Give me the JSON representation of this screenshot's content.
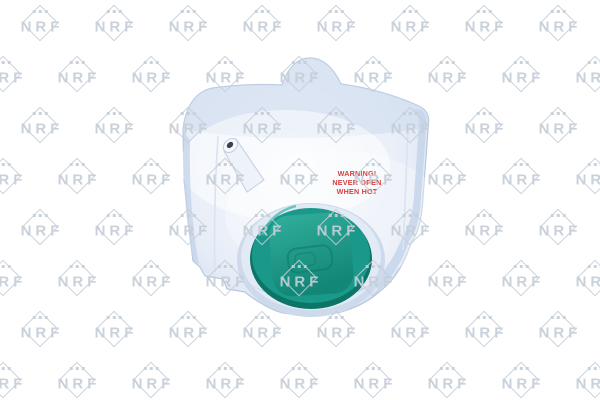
{
  "watermark": {
    "brand": "NRF",
    "color": "#c5ced8"
  },
  "product": {
    "name": "coolant-expansion-tank",
    "tank": {
      "highlight_color": "#f8fafd",
      "base_color": "#e7edf7",
      "edge_color": "#c6d5ea",
      "lid_color": "#cfdcee",
      "outline_color": "#b6c7dd"
    },
    "nozzle": {
      "body_color": "#eef3fa",
      "opening_color": "#3c4148"
    },
    "cap": {
      "base_color": "#0c7568",
      "ring_color": "#1a998a",
      "face_light_color": "#31ae9c",
      "face_dark_color": "#128677",
      "emboss_color": "#0d7c6e"
    },
    "warning": {
      "color": "#d6403f",
      "lines": [
        "WARNING!",
        "NEVER OPEN",
        "WHEN HOT"
      ]
    }
  }
}
